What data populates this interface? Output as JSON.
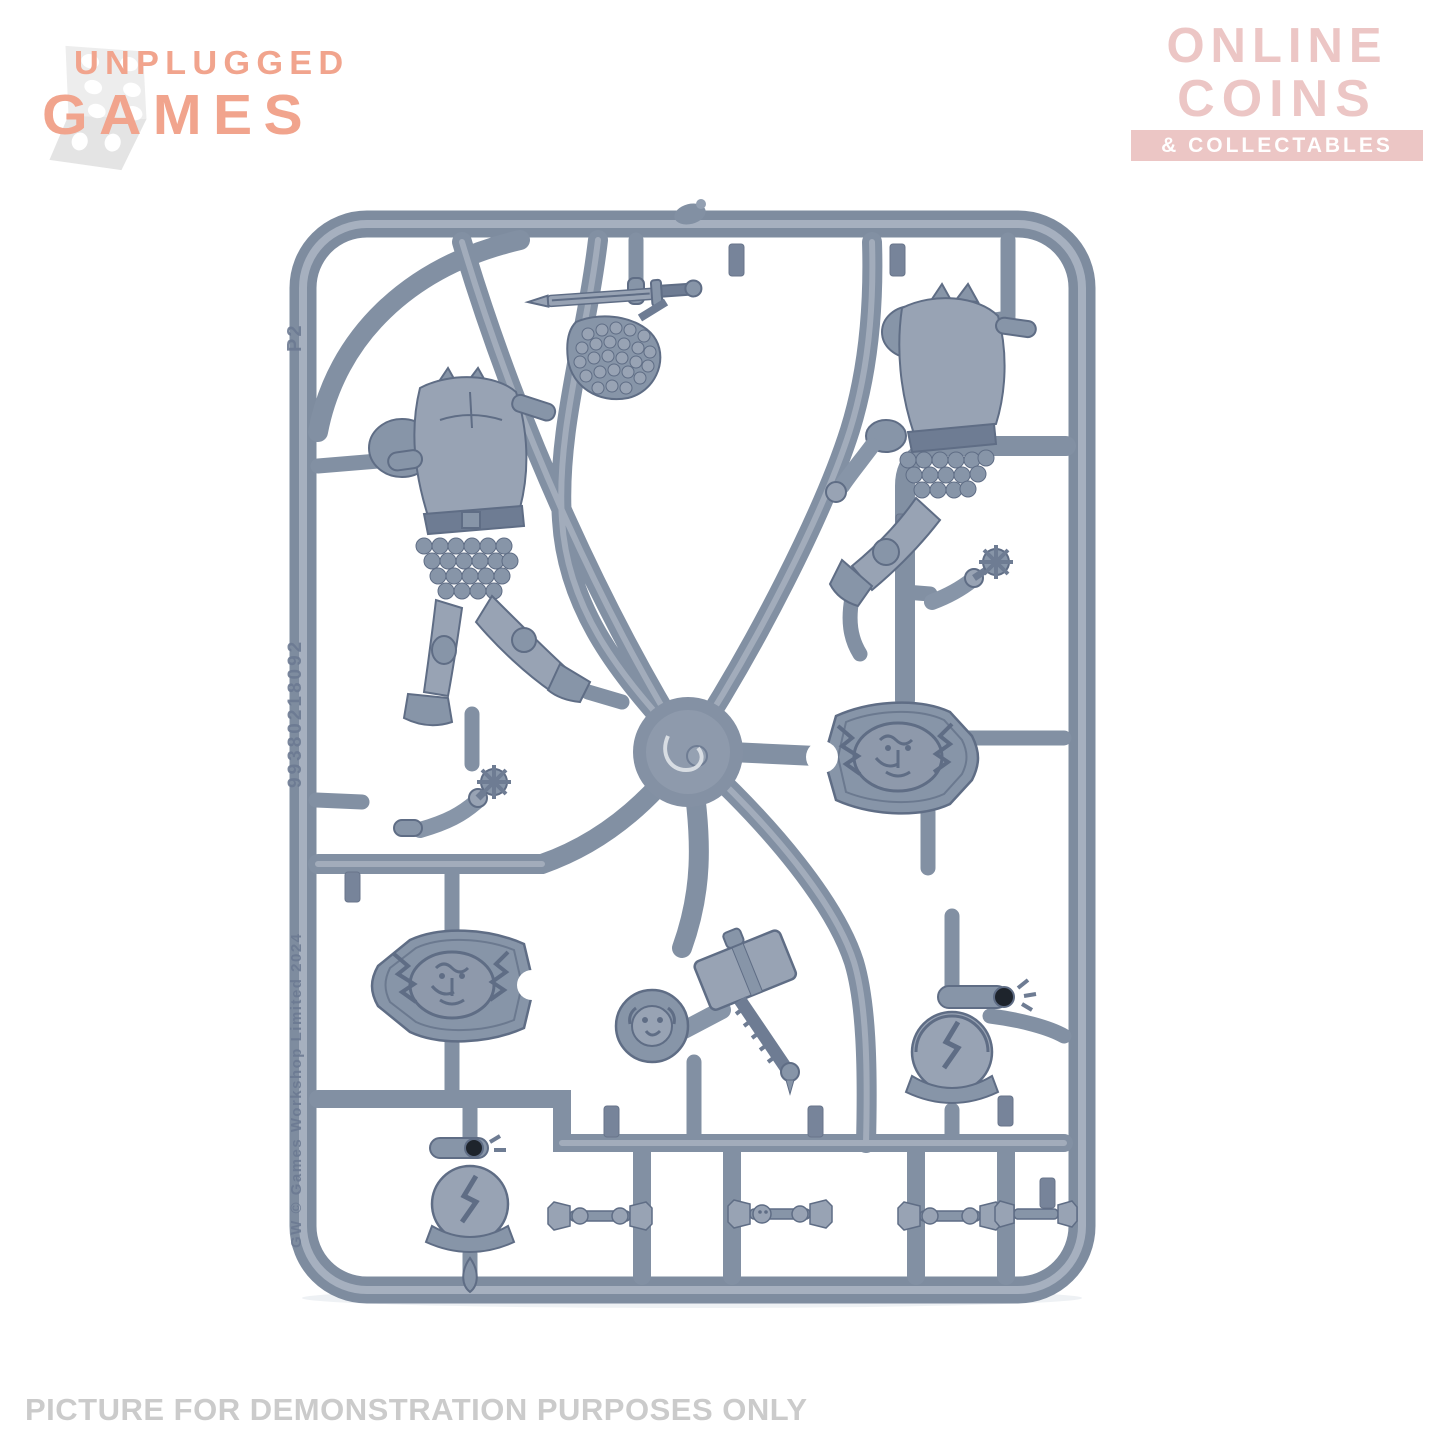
{
  "header": {
    "unplugged_logo": {
      "line1": "UNPLUGGED",
      "line2": "GAMES",
      "text_color": "#f1a48d",
      "dice_color": "#ececec"
    },
    "online_coins_logo": {
      "line1": "ONLINE",
      "line2": "COINS",
      "banner_label": "& COLLECTABLES",
      "text_color": "#ecc6c5",
      "banner_text_color": "#ffffff"
    }
  },
  "photo": {
    "alt": "Grey plastic miniatures sprue containing two armoured bodies, a chainmail piece with sword, two lion shields with lightning bolts, a warhammer with arm and lion shoulder pad, two crested helmets, two spiked mace arms and four small totem pieces",
    "plastic_color": "#8290a3",
    "molded_text": {
      "gate_label": "P2",
      "part_number": "99380218092",
      "copyright": "GW    © Games Workshop Limited 2024"
    }
  },
  "footer": {
    "caption": "PICTURE FOR DEMONSTRATION PURPOSES ONLY",
    "color": "#cbcbcb"
  }
}
